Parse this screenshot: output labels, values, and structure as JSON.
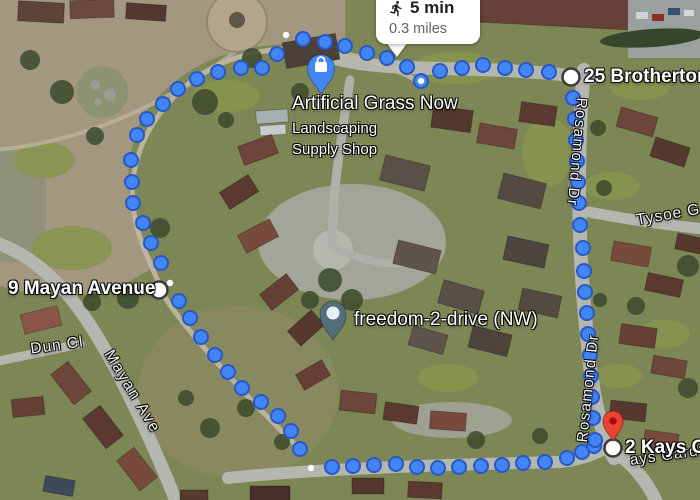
{
  "route_bubble": {
    "duration": "5 min",
    "distance": "0.3 miles",
    "icon": "walking-person-icon"
  },
  "labels": {
    "shop_title": "Artificial Grass Now",
    "shop_sub1": "Landscaping",
    "shop_sub2": "Supply Shop",
    "freedom": "freedom-2-drive (NW)",
    "brotherton": "25 Brotherton",
    "mayan_avenue": "9 Mayan Avenue",
    "kays": "2 Kays G",
    "street_rosamond_top": "Rosamond Dr",
    "street_rosamond_bottom": "Rosamond Dr",
    "street_tysoe": "Tysoe Ga",
    "street_mayan_ave": "Mayan Ave",
    "street_dun_cl": "Dun Cl",
    "street_kays_partial": "ays Gard"
  },
  "colors": {
    "route_dot_fill": "#4285F4",
    "route_dot_stroke": "#2A56C6",
    "red_pin": "#EA4335",
    "red_pin_inner": "#A50E0E",
    "shop_pin": "#4285F4",
    "freedom_pin": "#546E7A",
    "freedom_pin_inner": "#E4F1F5",
    "marker_ring": "#3a3a3a"
  },
  "route": {
    "dots": [
      [
        407,
        67
      ],
      [
        387,
        58
      ],
      [
        367,
        53
      ],
      [
        345,
        46
      ],
      [
        325,
        42
      ],
      [
        303,
        39
      ],
      [
        277,
        54
      ],
      [
        262,
        68
      ],
      [
        241,
        68
      ],
      [
        218,
        72
      ],
      [
        197,
        79
      ],
      [
        178,
        89
      ],
      [
        163,
        104
      ],
      [
        147,
        119
      ],
      [
        137,
        135
      ],
      [
        131,
        160
      ],
      [
        132,
        182
      ],
      [
        133,
        203
      ],
      [
        143,
        223
      ],
      [
        151,
        243
      ],
      [
        161,
        263
      ],
      [
        179,
        301
      ],
      [
        190,
        318
      ],
      [
        201,
        337
      ],
      [
        215,
        355
      ],
      [
        228,
        372
      ],
      [
        242,
        388
      ],
      [
        261,
        402
      ],
      [
        278,
        416
      ],
      [
        291,
        431
      ],
      [
        300,
        449
      ],
      [
        332,
        467
      ],
      [
        353,
        466
      ],
      [
        374,
        465
      ],
      [
        396,
        464
      ],
      [
        417,
        467
      ],
      [
        438,
        468
      ],
      [
        459,
        467
      ],
      [
        481,
        466
      ],
      [
        502,
        465
      ],
      [
        523,
        463
      ],
      [
        545,
        462
      ],
      [
        567,
        458
      ],
      [
        582,
        452
      ],
      [
        594,
        446
      ],
      [
        440,
        71
      ],
      [
        462,
        68
      ],
      [
        483,
        65
      ],
      [
        505,
        68
      ],
      [
        526,
        70
      ],
      [
        549,
        72
      ],
      [
        573,
        98
      ],
      [
        575,
        119
      ],
      [
        576,
        140
      ],
      [
        577,
        161
      ],
      [
        578,
        182
      ],
      [
        579,
        203
      ],
      [
        580,
        225
      ],
      [
        583,
        248
      ],
      [
        584,
        271
      ],
      [
        585,
        292
      ],
      [
        587,
        313
      ],
      [
        588,
        334
      ],
      [
        590,
        355
      ],
      [
        591,
        376
      ],
      [
        592,
        397
      ],
      [
        593,
        418
      ],
      [
        595,
        440
      ]
    ],
    "start_dot": [
      421,
      81
    ],
    "small_white_dots": [
      [
        286,
        35
      ],
      [
        170,
        283
      ],
      [
        311,
        468
      ]
    ],
    "white_circle_markers": [
      [
        571,
        77
      ],
      [
        159,
        290
      ],
      [
        613,
        448
      ]
    ]
  }
}
